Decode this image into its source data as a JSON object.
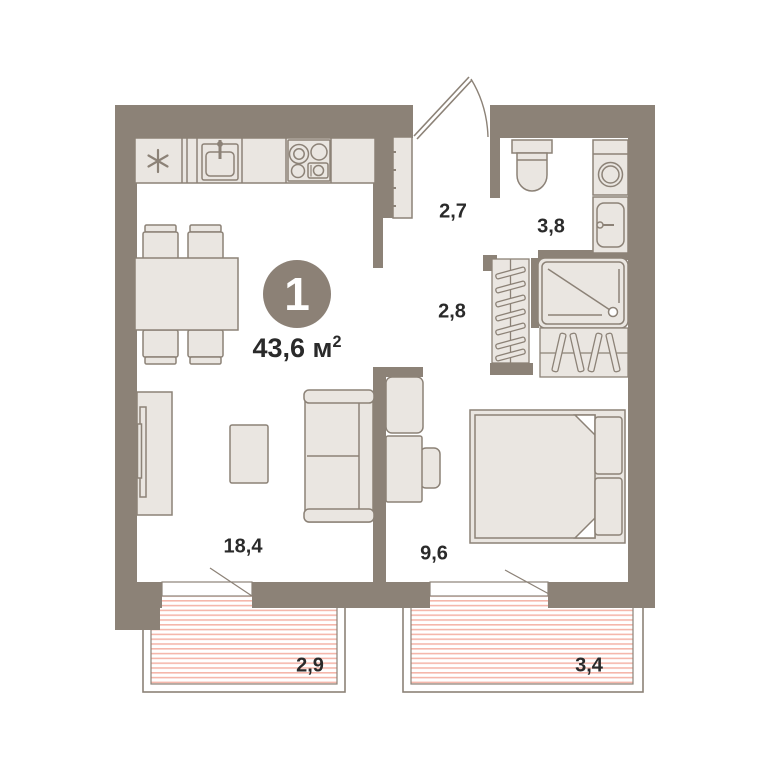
{
  "unit": {
    "rooms_badge": "1",
    "total_area": "43,6",
    "area_unit": "м",
    "area_exp": "2"
  },
  "room_labels": [
    {
      "name": "living-kitchen",
      "area": "18,4"
    },
    {
      "name": "bedroom",
      "area": "9,6"
    },
    {
      "name": "hallway",
      "area": "2,7"
    },
    {
      "name": "corridor",
      "area": "2,8"
    },
    {
      "name": "bathroom",
      "area": "3,8"
    },
    {
      "name": "balcony-left",
      "area": "2,9"
    },
    {
      "name": "balcony-right",
      "area": "3,4"
    }
  ],
  "colors": {
    "wall": "#8C8277",
    "furniture_fill": "#EAE6E1",
    "furniture_stroke": "#8C8277",
    "balcony_stripe": "#F5B7AB",
    "badge": "#8C8176",
    "text": "#2A2A2A",
    "background": "#FFFFFF"
  }
}
